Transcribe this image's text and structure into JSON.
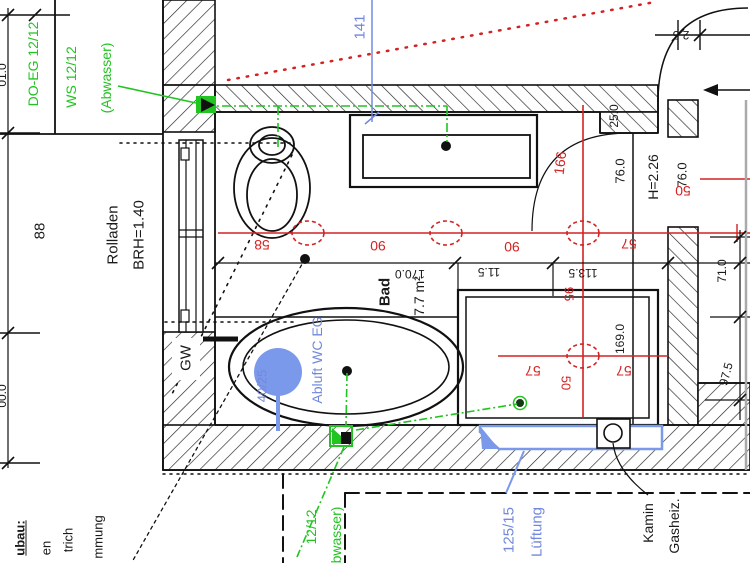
{
  "room": {
    "name": "Bad",
    "area": "7.7 m²"
  },
  "colors": {
    "dimension_red": "#d42222",
    "sewer_green": "#21c421",
    "hvac_blue": "#7288dd",
    "line_black": "#1a1a1a",
    "vent_fill_blue": "#7b99ea"
  },
  "labels": {
    "green": {
      "do_eg": "DO-EG 12/12",
      "ws": "WS 12/12",
      "abwasser": "(Abwasser)",
      "sewer_size": "12/12",
      "abwasser2": "(Abwasser)"
    },
    "blue": {
      "dim_141": "141",
      "abluft": "Abluft WC EG",
      "duct_40_25": "40/25",
      "duct_125_15": "125/15",
      "lueftung": "Lüftung"
    },
    "red": {
      "d58": "58",
      "d90a": "90",
      "d90b": "90",
      "d57a": "57",
      "d57b": "57",
      "d57c": "57",
      "d50_right": "50",
      "d50_shower": "50",
      "d95": "95",
      "d166": "166"
    },
    "black": {
      "d88": "88",
      "rolladen": "Rolladen",
      "brh": "BRH=1.40",
      "gw": "GW",
      "d170": "170.0",
      "d11_5": "11.5",
      "d113_5": "113.5",
      "d25_0": "25.0",
      "d76a": "76.0",
      "h_height": "H=2.26",
      "d76b": "76.0",
      "d71": "71.0",
      "d97_5": "97.5",
      "d169": "169.0",
      "d2_5": "2.5",
      "kamin": "Kamin",
      "gasheiz": "Gasheiz.",
      "cut_top": "01.0",
      "cut_bottom": "00.0"
    },
    "notes": {
      "l1": "ubau:",
      "l2": "en",
      "l3": "trich",
      "l4": "mmung"
    }
  }
}
